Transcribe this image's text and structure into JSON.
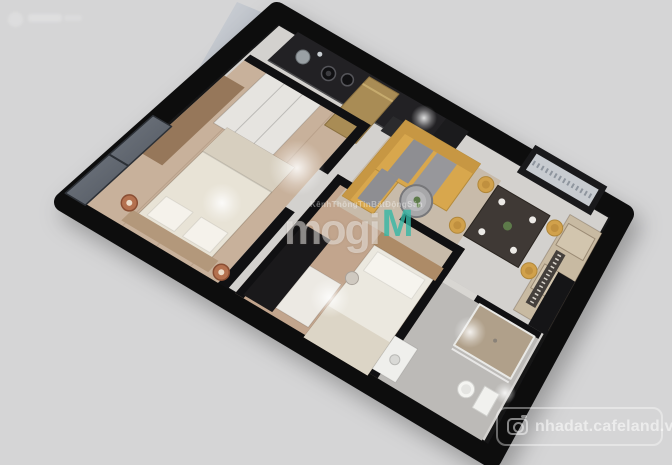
{
  "background_color": "#d5d5d6",
  "render": {
    "kind": "apartment-3d-floorplan-top-view",
    "rooms": [
      "master-bedroom",
      "kitchen",
      "living-room",
      "dining-area",
      "bedroom-2",
      "bathroom",
      "entrance-hall",
      "balcony-ledge"
    ],
    "furniture": [
      "double-bed",
      "nightstands",
      "closet",
      "dresser",
      "kitchen-counter",
      "sink",
      "burners",
      "fridge",
      "sofa",
      "coffee-table",
      "dining-table",
      "dining-chairs",
      "single-bed",
      "desk",
      "stool",
      "wardrobe",
      "toilet",
      "wash-basin",
      "shower-tray",
      "ac-ledge"
    ]
  },
  "watermarks": {
    "center": {
      "tagline": "KênhThôngTinBấtĐộngSản",
      "brand": "mogi",
      "brand_mark": "M",
      "brand_color": "#35b8a6"
    },
    "bottom_right": {
      "label": "nhadat.cafeland.vn",
      "icon": "camera-icon"
    }
  },
  "palette": {
    "wall": "#111113",
    "tile_floor": "#d3d1ce",
    "wood_floor_1": "#c8b19b",
    "wood_floor_2": "#c2a58d",
    "sofa_yellow": "#d8a74d",
    "copper": "#b4714f",
    "brass": "#a98c55",
    "teal_mark": "#35b8a6"
  }
}
